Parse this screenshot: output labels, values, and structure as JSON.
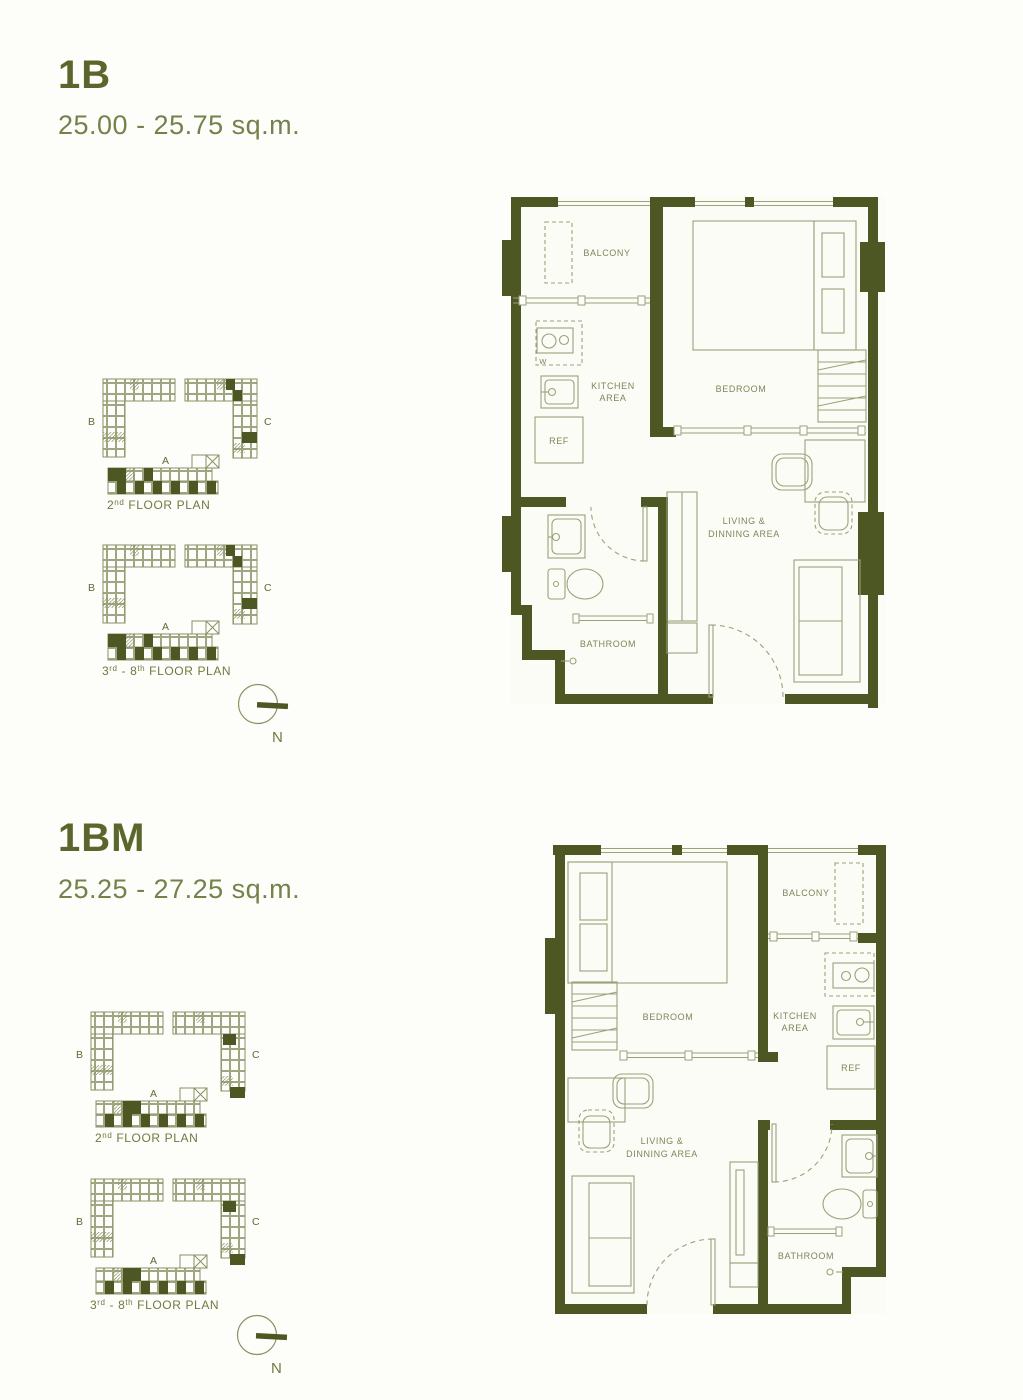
{
  "colors": {
    "wall": "#4d5724",
    "thin_line": "#9ba27a",
    "mini_plan_line": "#8a9164",
    "room_label": "#7c865a",
    "title": "#5a662b",
    "subtitle": "#73824a",
    "background": "#fdfdfa"
  },
  "units": [
    {
      "title": "1B",
      "area": "25.00 - 25.75 sq.m.",
      "wings": {
        "b": "B",
        "a": "A",
        "c": "C"
      },
      "compass": "N",
      "mini_plans": [
        {
          "caption": [
            "2",
            "nd",
            " FLOOR PLAN"
          ]
        },
        {
          "caption": [
            "3",
            "rd",
            " - 8",
            "th",
            " FLOOR PLAN"
          ]
        }
      ],
      "rooms": {
        "balcony": "BALCONY",
        "bedroom": "BEDROOM",
        "kitchen_line1": "KITCHEN",
        "kitchen_line2": "AREA",
        "ref": "REF",
        "washer": "W",
        "living_line1": "LIVING &",
        "living_line2": "DINNING AREA",
        "bathroom": "BATHROOM"
      }
    },
    {
      "title": "1BM",
      "area": "25.25 - 27.25 sq.m.",
      "wings": {
        "b": "B",
        "a": "A",
        "c": "C"
      },
      "compass": "N",
      "mini_plans": [
        {
          "caption": [
            "2",
            "nd",
            " FLOOR PLAN"
          ]
        },
        {
          "caption": [
            "3",
            "rd",
            " - 8",
            "th",
            " FLOOR PLAN"
          ]
        }
      ],
      "rooms": {
        "balcony": "BALCONY",
        "bedroom": "BEDROOM",
        "kitchen_line1": "KITCHEN",
        "kitchen_line2": "AREA",
        "ref": "REF",
        "living_line1": "LIVING &",
        "living_line2": "DINNING AREA",
        "bathroom": "BATHROOM"
      }
    }
  ]
}
